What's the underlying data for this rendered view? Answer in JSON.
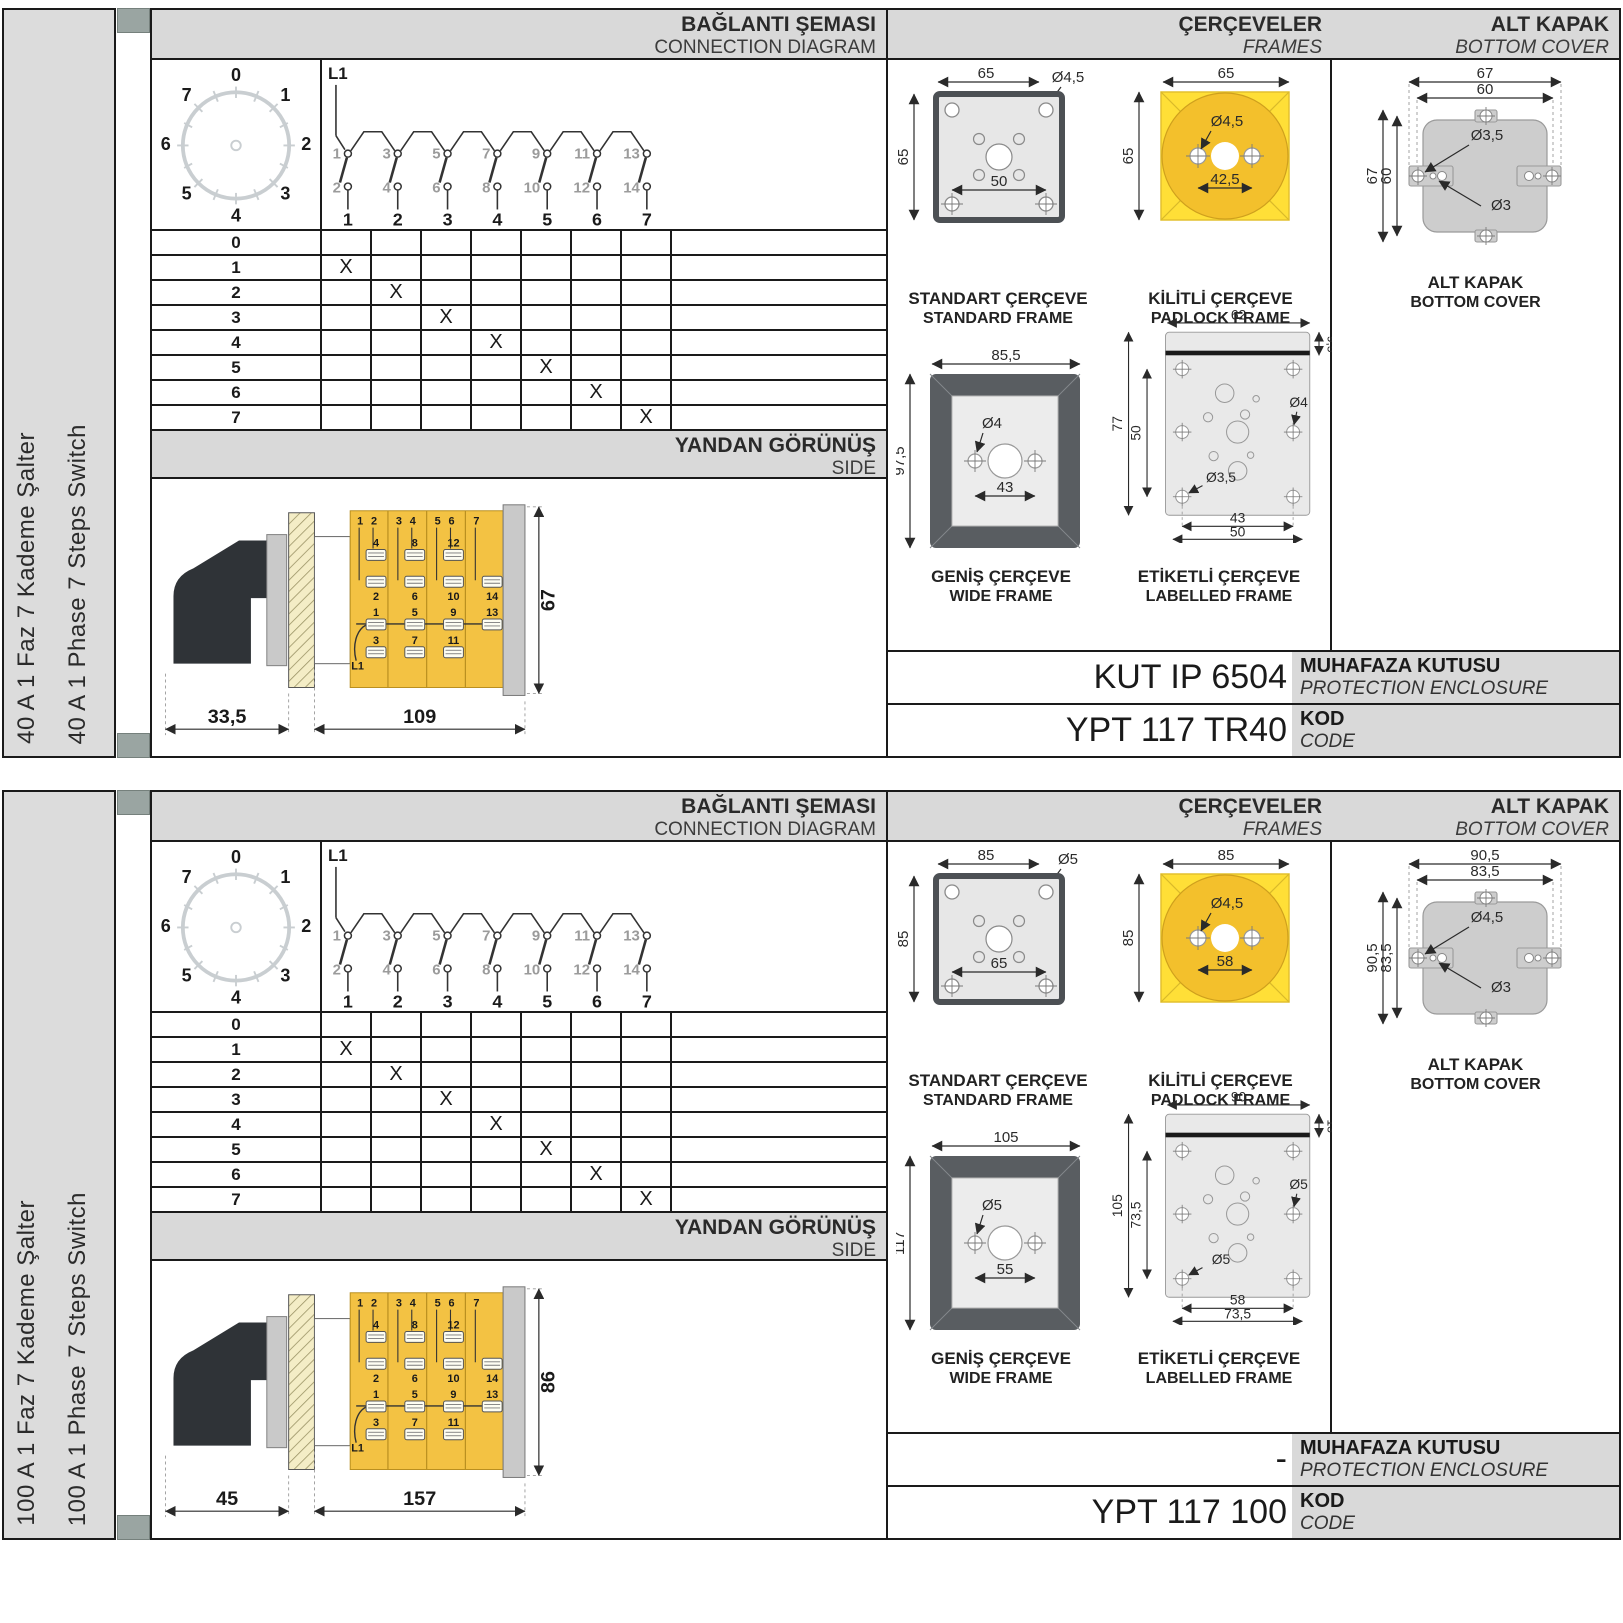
{
  "common": {
    "headers": {
      "connection_tr": "BAĞLANTI ŞEMASI",
      "connection_en": "CONNECTION DIAGRAM",
      "frames_tr": "ÇERÇEVELER",
      "frames_en": "FRAMES",
      "cover_tr": "ALT KAPAK",
      "cover_en": "BOTTOM COVER",
      "side_tr": "YANDAN GÖRÜNÜŞ",
      "side_en": "SIDE"
    },
    "captions": {
      "standard_tr": "STANDART ÇERÇEVE",
      "standard_en": "STANDARD FRAME",
      "padlock_tr": "KİLİTLİ ÇERÇEVE",
      "padlock_en": "PADLOCK FRAME",
      "wide_tr": "GENİŞ ÇERÇEVE",
      "wide_en": "WIDE FRAME",
      "labelled_tr": "ETİKETLİ ÇERÇEVE",
      "labelled_en": "LABELLED FRAME",
      "cover_tr": "ALT KAPAK",
      "cover_en": "BOTTOM COVER"
    },
    "code_labels": {
      "enclosure_tr": "MUHAFAZA KUTUSU",
      "enclosure_en": "PROTECTION ENCLOSURE",
      "code_tr": "KOD",
      "code_en": "CODE"
    },
    "dial": {
      "numbers": [
        "0",
        "1",
        "2",
        "3",
        "4",
        "5",
        "6",
        "7"
      ]
    },
    "circuit": {
      "phase": "L1",
      "top": [
        "1",
        "3",
        "5",
        "7",
        "9",
        "11",
        "13"
      ],
      "bottom": [
        "2",
        "4",
        "6",
        "8",
        "10",
        "12",
        "14"
      ],
      "outputs": [
        "1",
        "2",
        "3",
        "4",
        "5",
        "6",
        "7"
      ]
    },
    "table": {
      "mark": "X",
      "rows": [
        "0",
        "1",
        "2",
        "3",
        "4",
        "5",
        "6",
        "7"
      ]
    },
    "side_banks": [
      {
        "h1": "1",
        "h2": "2",
        "u1": "4",
        "u2": "2",
        "l1": "1",
        "l2": "3"
      },
      {
        "h1": "3",
        "h2": "4",
        "u1": "8",
        "u2": "6",
        "l1": "5",
        "l2": "7"
      },
      {
        "h1": "5",
        "h2": "6",
        "u1": "12",
        "u2": "10",
        "l1": "9",
        "l2": "11"
      },
      {
        "h1": "7",
        "u2": "14",
        "l1": "13"
      }
    ],
    "colors": {
      "body_yellow": "#f3c243",
      "padlock_yellow": "#ffdf37",
      "padlock_circle": "#f3c02c",
      "header_gray": "#d9d9d9",
      "marker_gray": "#9aa5a2",
      "line_black": "#1a1a1a",
      "hatch_beige": "#f4edc6",
      "frame_dark": "#595d61"
    }
  },
  "sections": [
    {
      "side_label_tr": "40 A 1 Faz 7 Kademe Şalter",
      "side_label_en": "40 A 1 Phase 7 Steps Switch",
      "side_view": {
        "a": "33,5",
        "b": "109",
        "h": "67"
      },
      "standard_frame": {
        "w": "65",
        "h": "65",
        "hole": "Ø4,5",
        "inner": "50"
      },
      "padlock_frame": {
        "w": "65",
        "h": "65",
        "hole": "Ø4,5",
        "inner": "42,5"
      },
      "wide_frame": {
        "w": "85,5",
        "h": "97,5",
        "hole": "Ø4",
        "inner": "43"
      },
      "labelled_frame": {
        "w": "62",
        "strip": "9,5",
        "h": "77",
        "inner_h": "50",
        "hole_right": "Ø4",
        "hole_left": "Ø3,5",
        "holes_w": "43",
        "outer_w2": "50"
      },
      "bottom_cover": {
        "outer_w": "67",
        "inner_w": "60",
        "outer_h": "67",
        "inner_h": "60",
        "hole_big": "Ø3,5",
        "hole_small": "Ø3"
      },
      "codes": {
        "enclosure": "KUT IP 6504",
        "code": "YPT 117 TR40"
      }
    },
    {
      "side_label_tr": "100 A 1 Faz 7 Kademe Şalter",
      "side_label_en": "100 A 1 Phase 7 Steps Switch",
      "side_view": {
        "a": "45",
        "b": "157",
        "h": "86"
      },
      "standard_frame": {
        "w": "85",
        "h": "85",
        "hole": "Ø5",
        "inner": "65"
      },
      "padlock_frame": {
        "w": "85",
        "h": "85",
        "hole": "Ø4,5",
        "inner": "58"
      },
      "wide_frame": {
        "w": "105",
        "h": "117",
        "hole": "Ø5",
        "inner": "55"
      },
      "labelled_frame": {
        "w": "90",
        "strip": "13",
        "h": "105",
        "inner_h": "73,5",
        "hole_right": "Ø5",
        "hole_left": "Ø5",
        "holes_w": "58",
        "outer_w2": "73,5"
      },
      "bottom_cover": {
        "outer_w": "90,5",
        "inner_w": "83,5",
        "outer_h": "90,5",
        "inner_h": "83,5",
        "hole_big": "Ø4,5",
        "hole_small": "Ø3"
      },
      "codes": {
        "enclosure": "-",
        "code": "YPT 117 100"
      }
    }
  ]
}
